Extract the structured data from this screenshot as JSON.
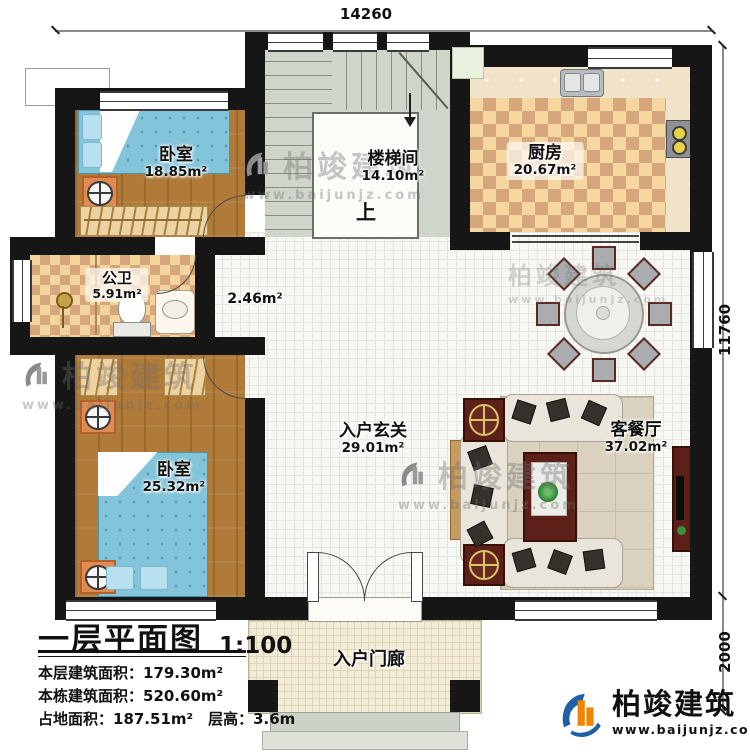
{
  "plan": {
    "dim_top": "14260",
    "dim_right": "11760",
    "dim_right_lower": "2000",
    "rooms": {
      "bedroom_top": {
        "name": "卧室",
        "area": "18.85m²"
      },
      "stairwell": {
        "name": "楼梯间",
        "area": "14.10m²",
        "up": "上"
      },
      "kitchen": {
        "name": "厨房",
        "area": "20.67m²"
      },
      "bathroom": {
        "name": "公卫",
        "area": "5.91m²"
      },
      "nook": {
        "area": "2.46m²"
      },
      "bedroom_bottom": {
        "name": "卧室",
        "area": "25.32m²"
      },
      "foyer": {
        "name": "入户玄关",
        "area": "29.01m²"
      },
      "living_dining": {
        "name": "客餐厅",
        "area": "37.02m²"
      },
      "porch": {
        "name": "入户门廊"
      }
    }
  },
  "title_block": {
    "title": "一层平面图",
    "scale": "1:100",
    "line1": "本层建筑面积：179.30m²",
    "line2": "本栋建筑面积：520.60m²",
    "line3": "占地面积：187.51m²　层高：3.6m"
  },
  "brand": {
    "name": "柏竣建筑",
    "url": "www.baijunjz.com"
  },
  "colors": {
    "wall": "#161616",
    "wood": "#b07a39",
    "checker_light": "#f5d79f",
    "checker_dark": "#d6a77d",
    "stair": "#cdd6c8",
    "accent_orange": "#e08b52",
    "maroon": "#5c2018",
    "brand_blue": "#1f5fa8",
    "brand_orange": "#f08300"
  }
}
